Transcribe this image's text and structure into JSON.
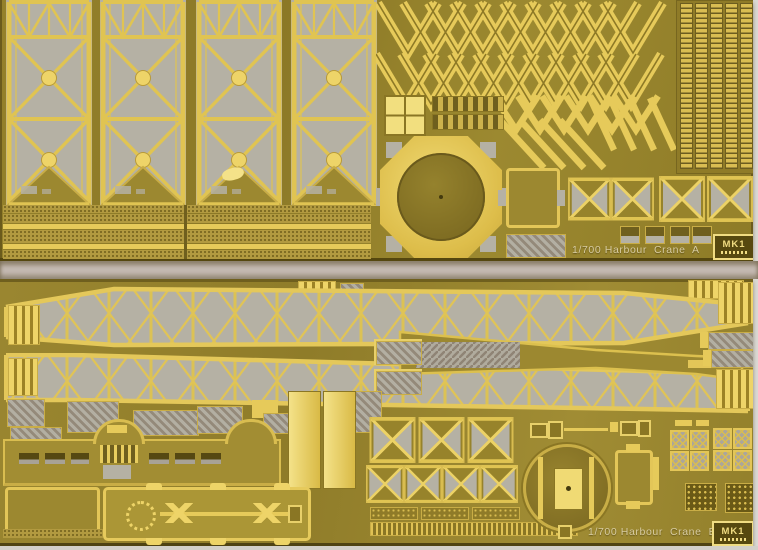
{
  "sheets": {
    "a": {
      "label": "1/700 Harbour  Crane  A",
      "brand": "MK1"
    },
    "b": {
      "label": "1/700 Harbour  Crane  B",
      "brand": "MK1"
    }
  },
  "colors": {
    "brass_base": "#97832b",
    "brass_bright": "#e6ca5a",
    "brass_highlight": "#f2df7f",
    "etched_gray": "#b5b1a4",
    "photo_background": "#dcdad4",
    "gap_background": "#c4b9b1",
    "label_text": "#d9cda2"
  }
}
